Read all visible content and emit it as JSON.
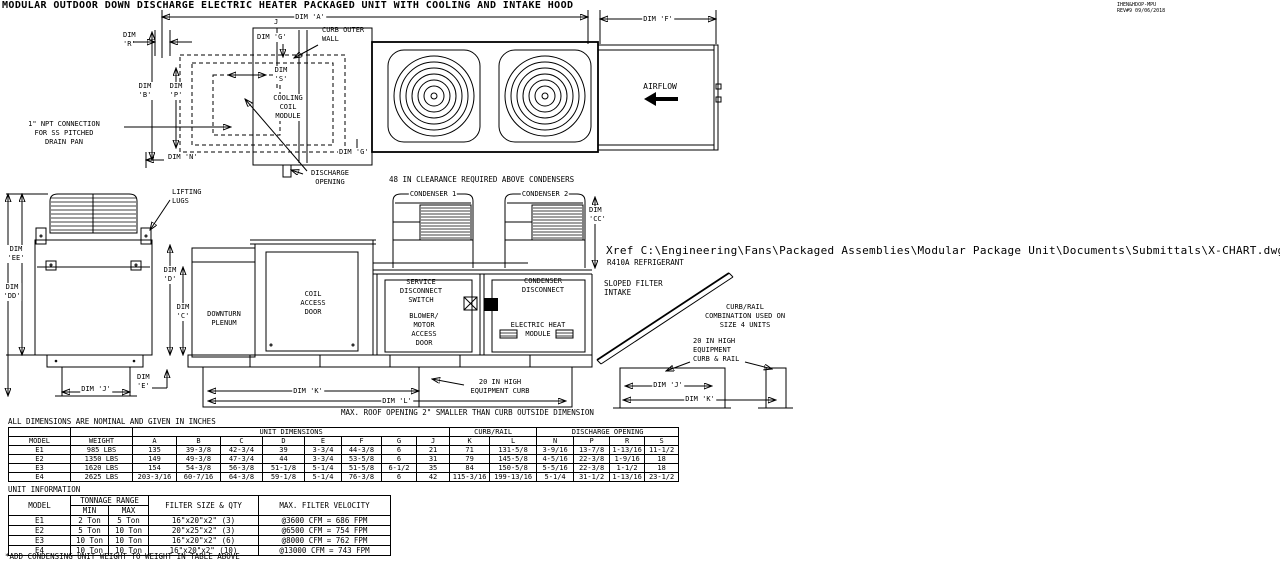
{
  "colors": {
    "line": "#000000",
    "background": "#ffffff"
  },
  "meta": {
    "title": "MODULAR OUTDOOR DOWN DISCHARGE ELECTRIC HEATER PACKAGED UNIT WITH COOLING AND INTAKE HOOD",
    "doc_number": "IHEN&HDOP-MPU",
    "revision": "REV#9 09/06/2018"
  },
  "labels": {
    "dim_a": "DIM 'A'",
    "j_ref": "J",
    "dim_f": "DIM 'F'",
    "curb_outer_wall": "CURB OUTER\nWALL",
    "dim_g_top": "DIM 'G'",
    "dim_r": "DIM\n'R'",
    "dim_b": "DIM\n'B'",
    "dim_p": "DIM\n'P'",
    "dim_s": "DIM\n'S'",
    "cooling_coil_module": "COOLING\nCOIL\nMODULE",
    "npt_note": "1\" NPT CONNECTION\nFOR SS PITCHED\nDRAIN PAN",
    "dim_n": "DIM 'N'",
    "dim_g_bottom": "DIM 'G'",
    "discharge_opening": "DISCHARGE\nOPENING",
    "clearance_note": "48 IN CLEARANCE REQUIRED ABOVE CONDENSERS",
    "airflow": "AIRFLOW",
    "lifting_lugs": "LIFTING\nLUGS",
    "dim_ee": "DIM\n'EE'",
    "dim_dd": "DIM\n'DD'",
    "dim_d": "DIM\n'D'",
    "dim_c": "DIM\n'C'",
    "downturn_plenum": "DOWNTURN\nPLENUM",
    "dim_j_left": "DIM 'J'",
    "dim_e_left": "DIM\n'E'",
    "condenser_1": "CONDENSER 1",
    "condenser_2": "CONDENSER 2",
    "dim_cc": "DIM\n'CC'",
    "coil_access_door": "COIL\nACCESS\nDOOR",
    "service_disconnect": "SERVICE\nDISCONNECT\nSWITCH",
    "blower_motor": "BLOWER/\nMOTOR\nACCESS\nDOOR",
    "condenser_disconnect": "CONDENSER\nDISCONNECT",
    "electric_heat": "ELECTRIC HEAT\nMODULE",
    "sloped_filter": "SLOPED FILTER\nINTAKE",
    "xref": "Xref C:\\Engineering\\Fans\\Packaged Assemblies\\Modular Package Unit\\Documents\\Submittals\\X-CHART.dwg",
    "refrigerant": "R410A REFRIGERANT",
    "curb_rail_note": "CURB/RAIL\nCOMBINATION USED ON\nSIZE 4 UNITS",
    "curb_rail_label": "20 IN HIGH\nEQUIPMENT\nCURB & RAIL",
    "equipment_curb": "20 IN HIGH\nEQUIPMENT CURB",
    "dim_k_main": "DIM 'K'",
    "dim_l": "DIM 'L'",
    "roof_note": "MAX. ROOF OPENING 2\" SMALLER THAN CURB OUTSIDE DIMENSION",
    "dim_j_detail": "DIM 'J'",
    "dim_k_detail": "DIM 'K'"
  },
  "table1": {
    "title": "ALL DIMENSIONS ARE NOMINAL AND GIVEN IN INCHES",
    "groups": {
      "unit_dimensions": "UNIT DIMENSIONS",
      "curb_rail": "CURB/RAIL",
      "discharge_opening": "DISCHARGE OPENING"
    },
    "columns": [
      "MODEL",
      "WEIGHT",
      "A",
      "B",
      "C",
      "D",
      "E",
      "F",
      "G",
      "J",
      "K",
      "L",
      "N",
      "P",
      "R",
      "S"
    ],
    "rows": [
      [
        "E1",
        "985 LBS",
        "135",
        "39-3/8",
        "42-3/4",
        "39",
        "3-3/4",
        "44-3/8",
        "6",
        "21",
        "71",
        "131-5/8",
        "3-9/16",
        "13-7/8",
        "1-13/16",
        "11-1/2"
      ],
      [
        "E2",
        "1350 LBS",
        "149",
        "49-3/8",
        "47-3/4",
        "44",
        "3-3/4",
        "53-5/8",
        "6",
        "31",
        "79",
        "145-5/8",
        "4-5/16",
        "22-3/8",
        "1-9/16",
        "18"
      ],
      [
        "E3",
        "1620 LBS",
        "154",
        "54-3/8",
        "56-3/8",
        "51-1/8",
        "5-1/4",
        "51-5/8",
        "6-1/2",
        "35",
        "84",
        "150-5/8",
        "5-5/16",
        "22-3/8",
        "1-1/2",
        "18"
      ],
      [
        "E4",
        "2625 LBS",
        "203-3/16",
        "60-7/16",
        "64-3/8",
        "59-1/8",
        "5-1/4",
        "76-3/8",
        "6",
        "42",
        "115-3/16",
        "199-13/16",
        "5-1/4",
        "31-1/2",
        "1-13/16",
        "23-1/2"
      ]
    ]
  },
  "table2": {
    "title": "UNIT INFORMATION",
    "headers": {
      "model": "MODEL",
      "tonnage_range": "TONNAGE RANGE",
      "min": "MIN",
      "max": "MAX",
      "filter": "FILTER SIZE & QTY",
      "velocity": "MAX. FILTER VELOCITY"
    },
    "rows": [
      [
        "E1",
        "2 Ton",
        "5 Ton",
        "16\"x20\"x2\" (3)",
        "@3600 CFM = 686 FPM"
      ],
      [
        "E2",
        "5 Ton",
        "10 Ton",
        "20\"x25\"x2\" (3)",
        "@6500 CFM = 754 FPM"
      ],
      [
        "E3",
        "10 Ton",
        "10 Ton",
        "16\"x20\"x2\" (6)",
        "@8000 CFM = 762 FPM"
      ],
      [
        "E4",
        "10 Ton",
        "10 Ton",
        "16\"x20\"x2\" (10)",
        "@13000 CFM = 743 FPM"
      ]
    ]
  },
  "footnote": "*ADD CONDENSING UNIT WEIGHT TO WEIGHT IN TABLE ABOVE"
}
